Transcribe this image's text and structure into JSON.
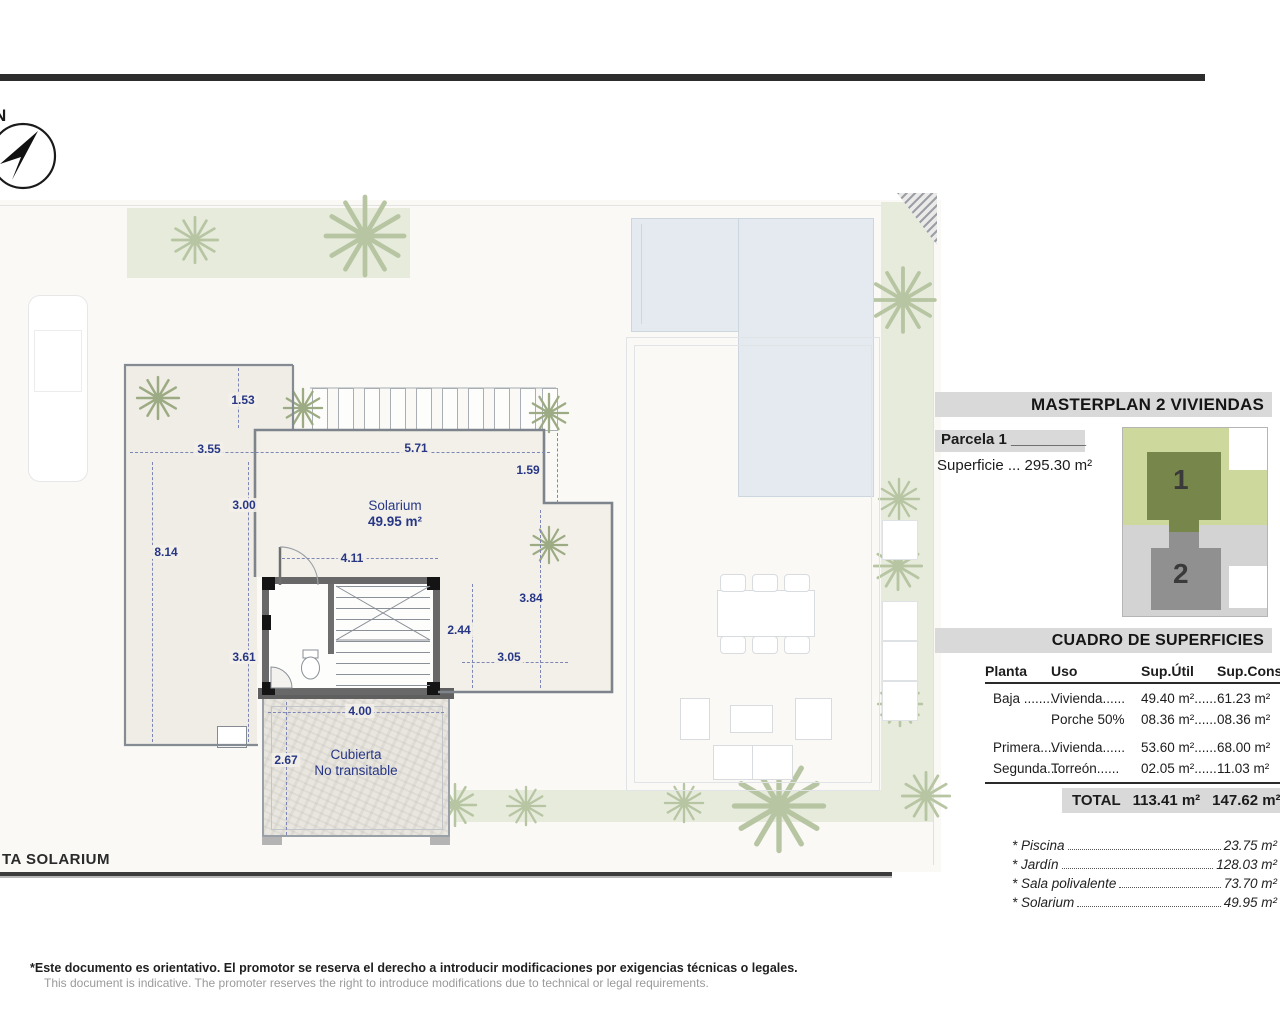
{
  "compass": {
    "north": "N"
  },
  "plan": {
    "room": {
      "name": "Solarium",
      "area": "49.95 m²"
    },
    "cubierta": {
      "line1": "Cubierta",
      "line2": "No transitable"
    },
    "dims": [
      "1.53",
      "3.55",
      "5.71",
      "1.59",
      "3.00",
      "8.14",
      "4.11",
      "3.84",
      "2.44",
      "3.05",
      "3.61",
      "4.00",
      "2.67"
    ],
    "footer_label": "TA SOLARIUM"
  },
  "panel": {
    "masterplan_title": "MASTERPLAN 2 VIVIENDAS",
    "parcela": "Parcela 1 _________",
    "superficie": "Superficie ... 295.30 m²",
    "site": {
      "plot1": "1",
      "plot2": "2"
    },
    "cuadro_title": "CUADRO DE SUPERFICIES",
    "table": {
      "headers": [
        "Planta",
        "Uso",
        "Sup.Útil",
        "Sup.Const."
      ],
      "rows": [
        [
          "Baja ........",
          "Vivienda......",
          "49.40 m²......",
          "61.23 m²"
        ],
        [
          "",
          "Porche 50%",
          "08.36 m²......",
          "08.36 m²"
        ],
        [
          "Primera....",
          "Vivienda......",
          "53.60 m²......",
          "68.00 m²"
        ],
        [
          "Segunda...",
          "Torreón......",
          "02.05 m²......",
          "11.03 m²"
        ]
      ],
      "total_label": "TOTAL",
      "total_util": "113.41 m²",
      "total_const": "147.62 m²"
    },
    "extras": [
      {
        "label": "* Piscina",
        "value": "23.75 m²"
      },
      {
        "label": "* Jardín",
        "value": "128.03 m²"
      },
      {
        "label": "* Sala polivalente",
        "value": "73.70 m²"
      },
      {
        "label": "* Solarium",
        "value": "49.95 m²"
      }
    ]
  },
  "footer": {
    "disclaimer_es": "*Este documento es orientativo. El promotor se reserva el derecho a introducir modificaciones por exigencias técnicas o legales.",
    "disclaimer_en": "This document is indicative. The promoter reserves the right to introduce modifications due to technical or legal requirements."
  },
  "colors": {
    "dimension_text": "#273786",
    "plot1_fill": "#77874b",
    "plot2_fill": "#909090",
    "pool_fill": "#e4eaf0",
    "garden_fill": "#e6ebdc"
  }
}
